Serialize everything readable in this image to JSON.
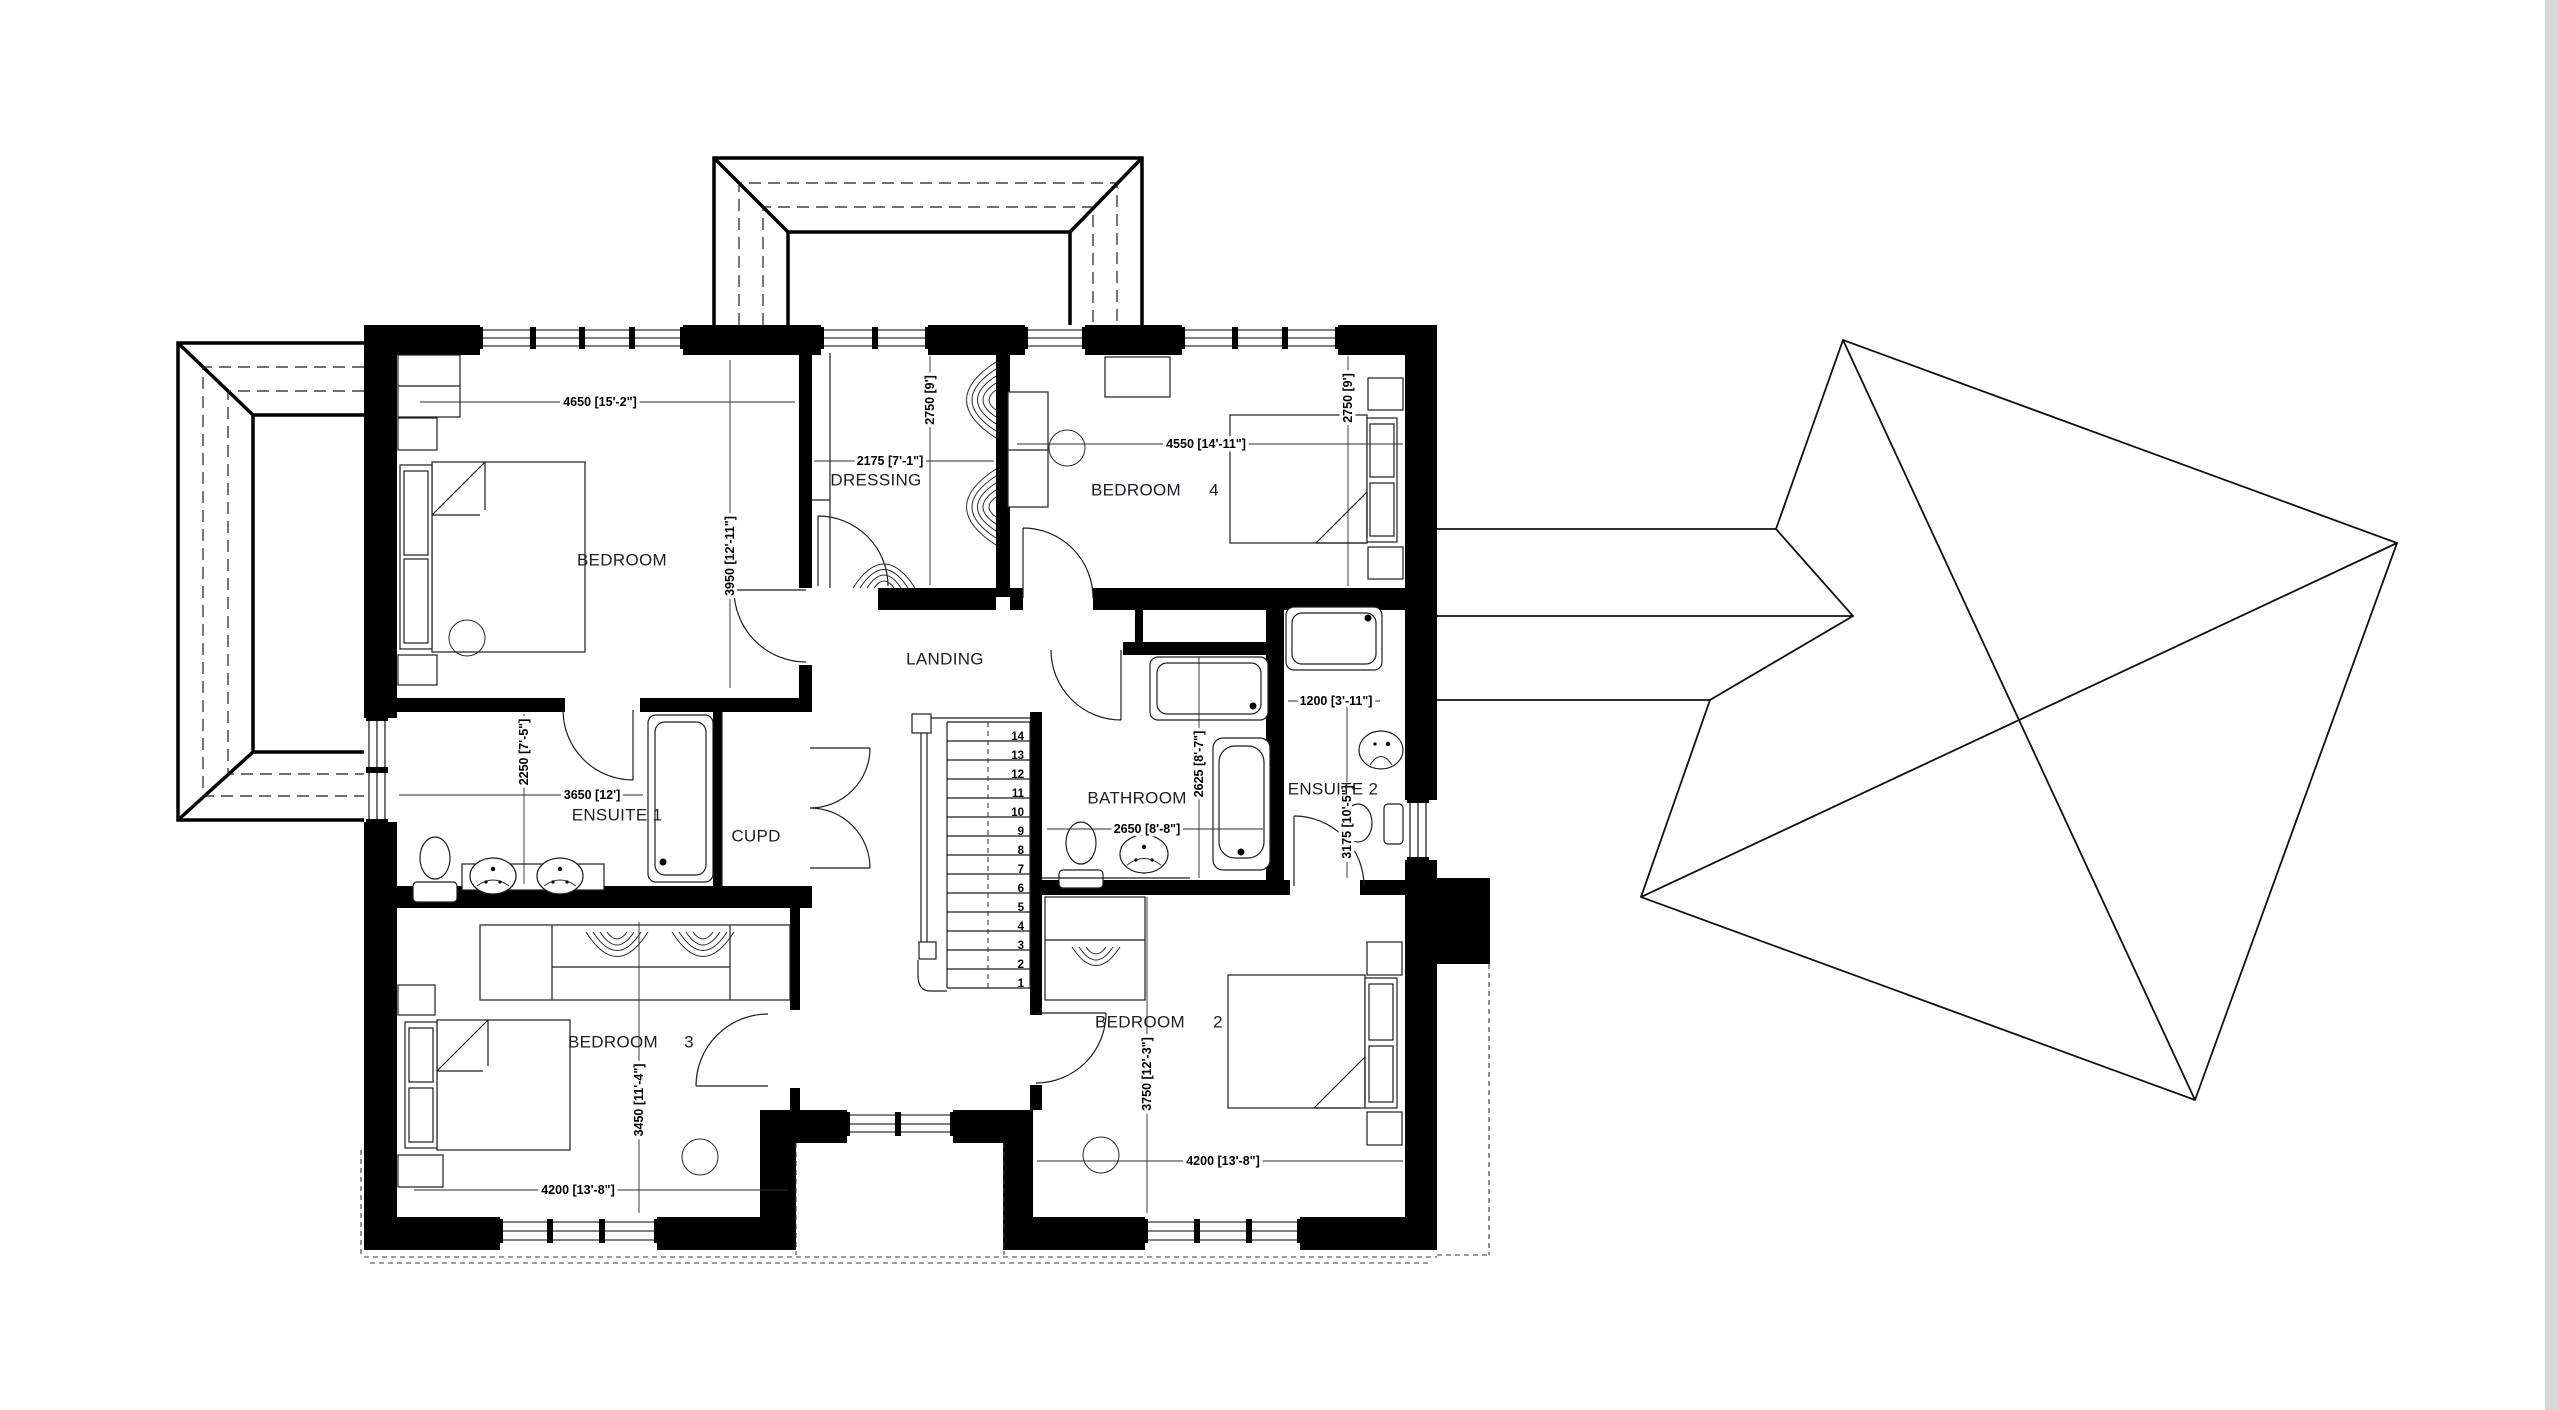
{
  "plan": {
    "rooms": {
      "bedroom1": {
        "label": "BEDROOM",
        "dim_w": "4650 [15'-2\"]",
        "dim_h": "3950 [12'-11\"]"
      },
      "dressing": {
        "label": "DRESSING",
        "dim_w": "2175 [7'-1\"]",
        "dim_h": "2750 [9']"
      },
      "bedroom4": {
        "label": "BEDROOM",
        "number": "4",
        "dim_w": "4550 [14'-11\"]",
        "dim_h": "2750 [9']"
      },
      "landing": {
        "label": "LANDING"
      },
      "ensuite1": {
        "label": "ENSUITE 1",
        "dim_w": "3650 [12']",
        "dim_h": "2250 [7'-5\"]"
      },
      "cupd": {
        "label": "CUPD"
      },
      "bathroom": {
        "label": "BATHROOM",
        "dim_w": "2650 [8'-8\"]",
        "dim_h": "2625 [8'-7\"]"
      },
      "ensuite2": {
        "label": "ENSUITE 2",
        "dim_w": "1200 [3'-11\"]",
        "dim_h": "3175 [10'-5\"]"
      },
      "bedroom3": {
        "label": "BEDROOM",
        "number": "3",
        "dim_w": "4200 [13'-8\"]",
        "dim_h": "3450 [11'-4\"]"
      },
      "bedroom2": {
        "label": "BEDROOM",
        "number": "2",
        "dim_w": "4200 [13'-8\"]",
        "dim_h": "3750 [12'-3\"]"
      }
    },
    "stairs": {
      "numbers": [
        "14",
        "13",
        "12",
        "11",
        "10",
        "9",
        "8",
        "7",
        "6",
        "5",
        "4",
        "3",
        "2",
        "1"
      ]
    }
  }
}
